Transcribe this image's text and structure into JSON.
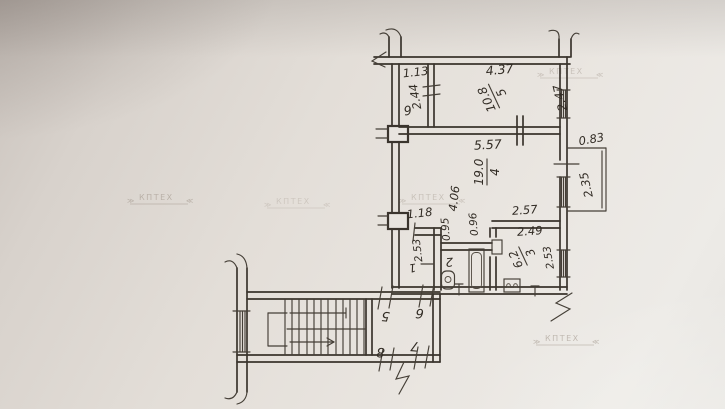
{
  "watermark": {
    "text": "КПТЕХ",
    "flank_left": "≫",
    "flank_right": "≪"
  },
  "apartment": {
    "room1": {
      "number": "1",
      "dim_length": "2.53"
    },
    "room2": {
      "number": "2"
    },
    "room3": {
      "number": "3",
      "area": "6.2",
      "dim_top": "2.57",
      "dim_inner": "2.49",
      "dim_side": "2.53"
    },
    "room4": {
      "number": "4",
      "area": "19.0",
      "dim_top": "5.57",
      "dim_side": "4.06"
    },
    "room5": {
      "number": "5",
      "area": "10.8",
      "dim_top": "4.37",
      "dim_side": "2.47"
    },
    "room6": {
      "number": "6",
      "dim_top": "1.13",
      "dim_side": "2.44"
    },
    "hall": {
      "dim": "1.18"
    },
    "wet_zone": {
      "dim_a": "0.95",
      "dim_b": "0.96"
    },
    "balcony": {
      "dim_depth": "0.83",
      "dim_length": "2.35"
    }
  },
  "stairwell": {
    "marks": [
      "5",
      "6",
      "8",
      "7"
    ]
  }
}
